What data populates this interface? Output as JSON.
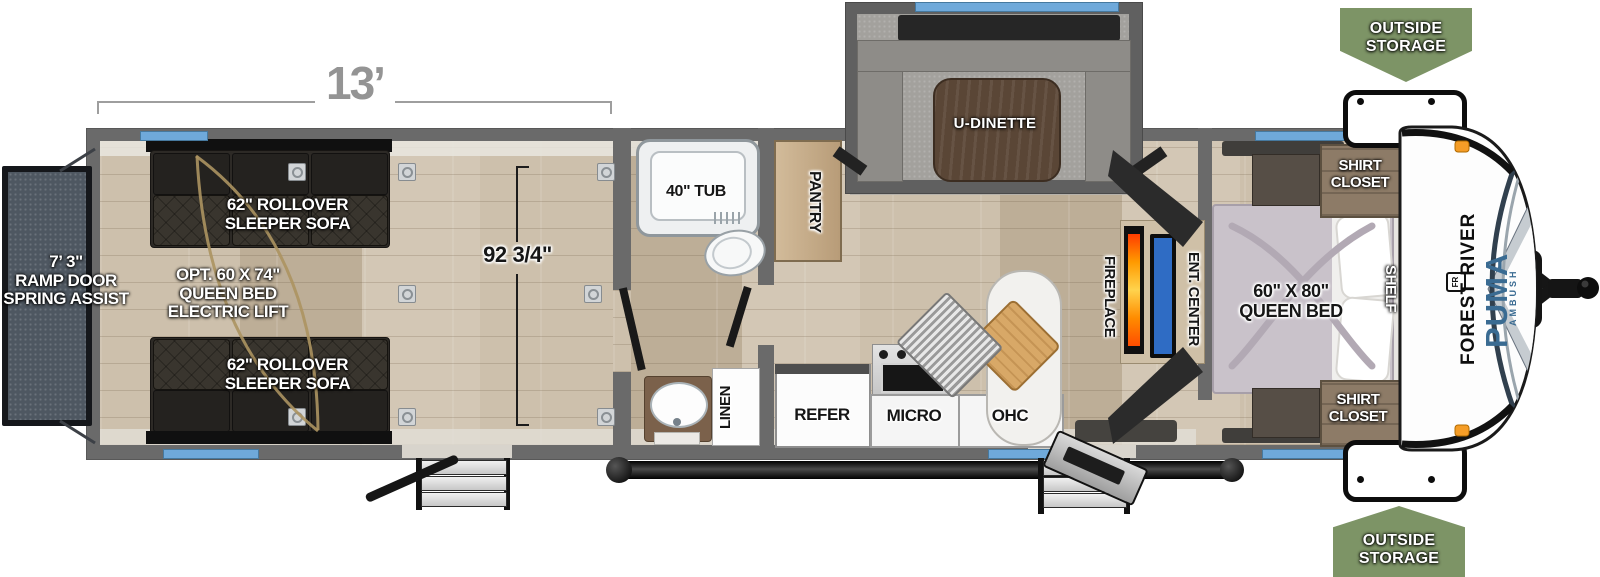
{
  "plan": {
    "brand": "FOREST RIVER",
    "model": "PUMA",
    "series": "AMBUSH",
    "monogram": "FR"
  },
  "dimensions": {
    "garage_length": "13’",
    "garage_width": "92 3/4\"",
    "ramp_line1": "7’ 3\"",
    "ramp_line2": "RAMP DOOR",
    "ramp_line3": "SPRING ASSIST"
  },
  "outside_storage": {
    "line1": "OUTSIDE",
    "line2": "STORAGE"
  },
  "garage": {
    "sofa_line1": "62\" ROLLOVER",
    "sofa_line2": "SLEEPER SOFA",
    "opt_line1": "OPT. 60 X 74\"",
    "opt_line2": "QUEEN BED",
    "opt_line3": "ELECTRIC LIFT"
  },
  "bathroom": {
    "tub": "40\" TUB",
    "linen": "LINEN"
  },
  "kitchen": {
    "pantry": "PANTRY",
    "refrigerator": "REFER",
    "microwave": "MICRO",
    "overhead_cabinet": "OHC",
    "dinette": "U-DINETTE"
  },
  "living": {
    "fireplace": "FIREPLACE",
    "entertainment_center": "ENT. CENTER"
  },
  "bedroom": {
    "bed_line1": "60\" X 80\"",
    "bed_line2": "QUEEN BED",
    "shirt_closet_line1": "SHIRT",
    "shirt_closet_line2": "CLOSET",
    "shelf": "SHELF"
  },
  "colors": {
    "wall_gray": "#6a6a6a",
    "window_blue": "#6fa9da",
    "banner_green": "#7d9466",
    "floor_wood": "#c7baa6",
    "puma_blue": "#3a6b92",
    "fireplace_orange": "#ff8c00",
    "tv_screen_blue": "#2f6cc4",
    "marker_light_orange": "#f59d27"
  }
}
